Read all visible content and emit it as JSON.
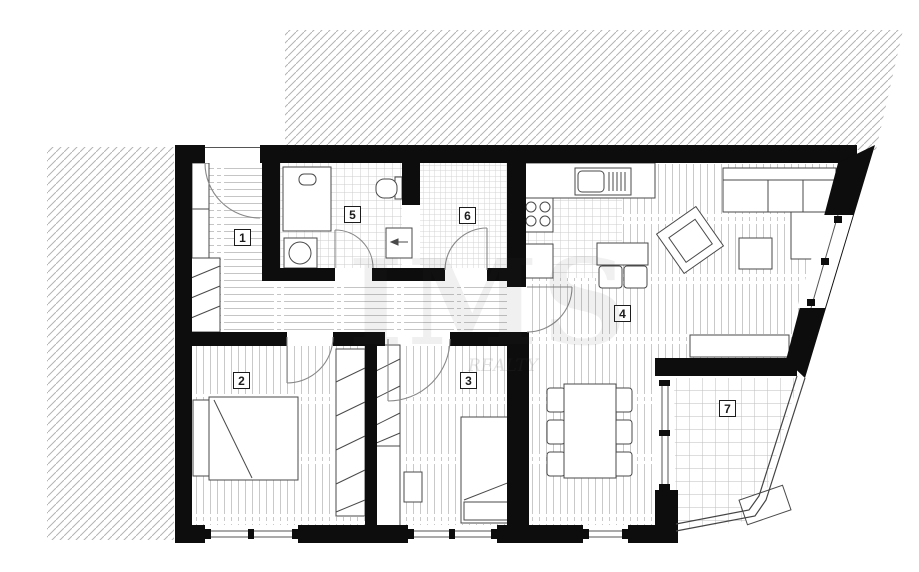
{
  "floorplan": {
    "background": "#ffffff",
    "wall_color": "#0d0d0d",
    "furniture_line_color": "#4a4a4a",
    "floor_line_color": "#c9c9c9",
    "hatch_color": "#b3b3b3",
    "rooms": [
      {
        "id": "room-1",
        "label": "1"
      },
      {
        "id": "room-2",
        "label": "2"
      },
      {
        "id": "room-3",
        "label": "3"
      },
      {
        "id": "room-4",
        "label": "4"
      },
      {
        "id": "room-5",
        "label": "5"
      },
      {
        "id": "room-6",
        "label": "6"
      },
      {
        "id": "room-7",
        "label": "7"
      }
    ],
    "watermark": {
      "text": "IMS",
      "subtext": "REALTY"
    }
  }
}
